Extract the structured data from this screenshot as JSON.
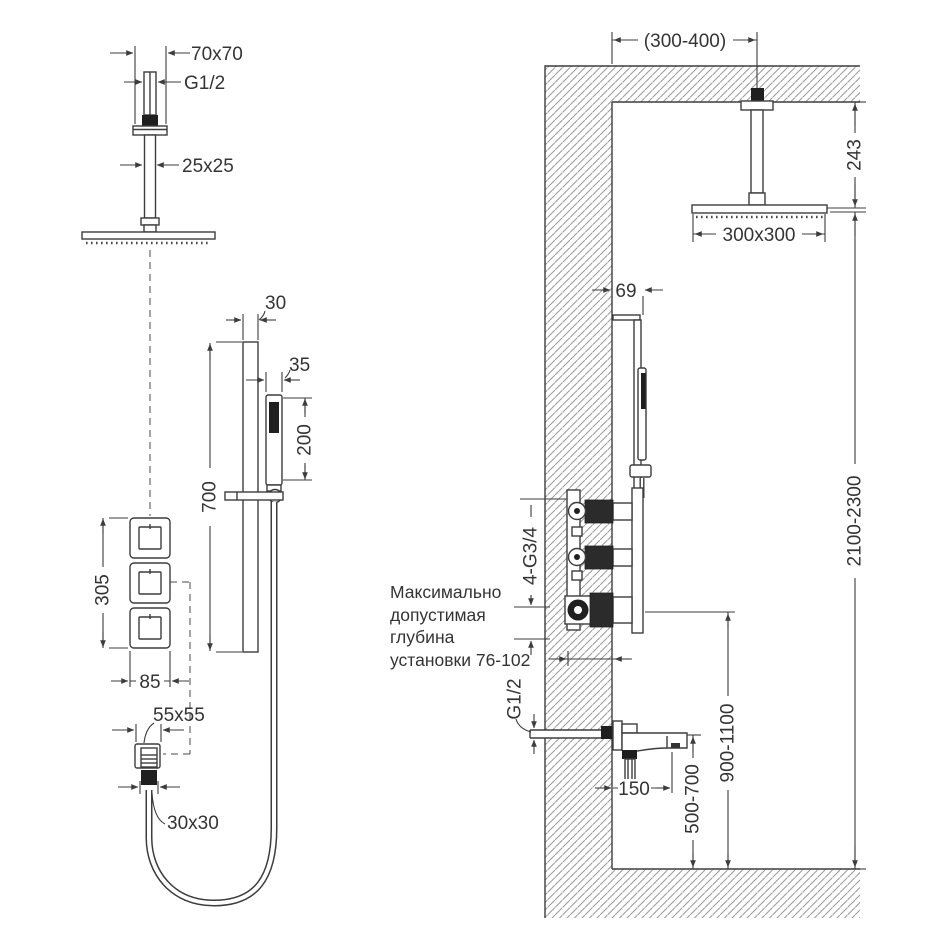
{
  "drawing": {
    "front": {
      "head": {
        "escutcheon": "70x70",
        "thread": "G1/2",
        "arm": "25x25"
      },
      "bar": {
        "width": "30",
        "length": "700"
      },
      "hand": {
        "width": "35",
        "length": "200"
      },
      "mixer": {
        "span": "305",
        "plate": "85"
      },
      "outlet": {
        "escutcheon": "55x55",
        "connector": "30x30"
      }
    },
    "side": {
      "head": {
        "offset": "(300-400)",
        "drop": "243",
        "size": "300x300"
      },
      "bar": {
        "offset": "69"
      },
      "mixer": {
        "connections": "4-G3/4",
        "height": "900-1100"
      },
      "note": {
        "line1": "Максимально",
        "line2": "допустимая",
        "line3": "глубина",
        "line4": "установки 76-102"
      },
      "spout": {
        "thread": "G1/2",
        "length": "150",
        "height": "500-700"
      },
      "room": {
        "height": "2100-2300"
      }
    }
  },
  "colors": {
    "line": "#3d3d3d",
    "hatch": "#9a9a9a",
    "text": "#343434",
    "fill_dark": "#1f1f1f",
    "background": "#ffffff"
  }
}
